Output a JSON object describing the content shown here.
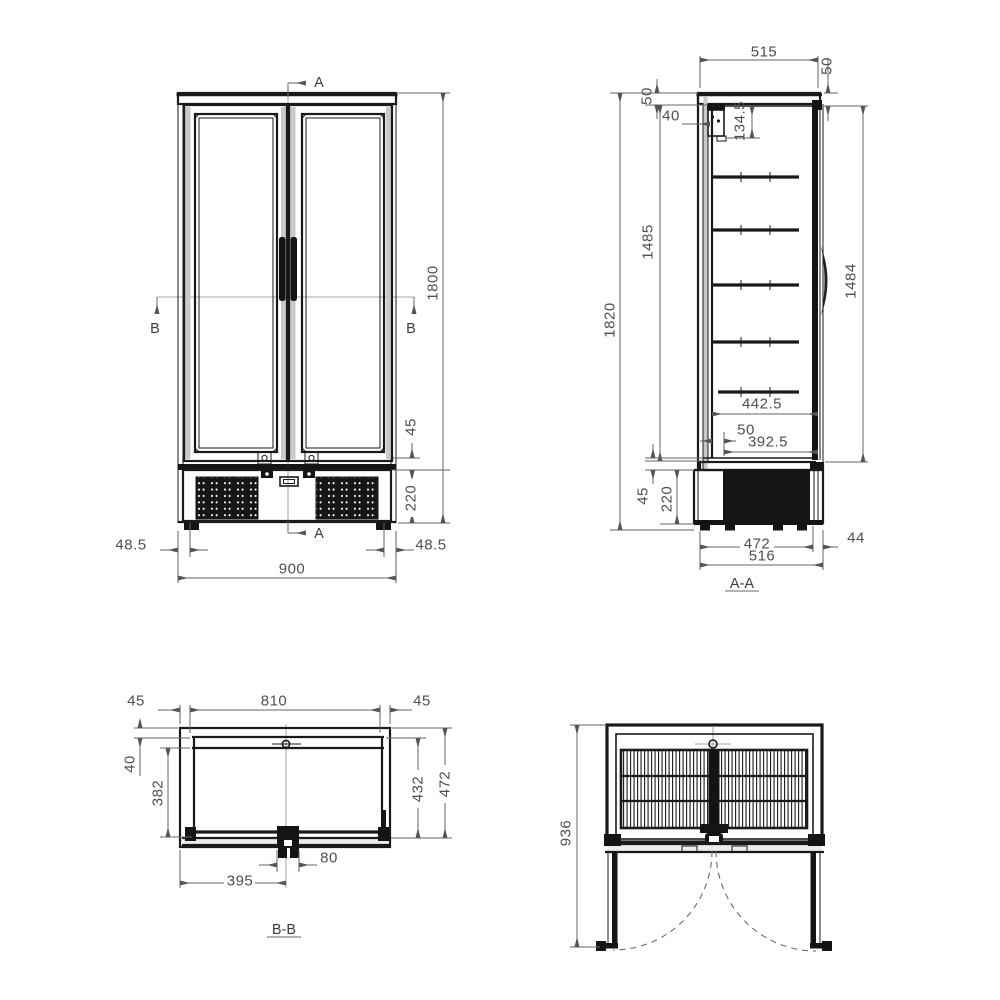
{
  "palette": {
    "line": "#1a1a1a",
    "dim_line": "#666666",
    "dim_text": "#4f4f4f",
    "shade": "#c9c9c9",
    "background": "#ffffff"
  },
  "front": {
    "section_a": "A",
    "section_b": "B",
    "height_total": "1800",
    "door_gap": "45",
    "base_height": "220",
    "offset_left": "48.5",
    "offset_right": "48.5",
    "width_total": "900"
  },
  "aa": {
    "title": "A-A",
    "width_top": "515",
    "top_right": "50",
    "top_left": "50",
    "evap_width": "40",
    "evap_height": "134.5",
    "height_inner": "1485",
    "height_total": "1820",
    "height_door": "1484",
    "shelf_depth": "442.5",
    "wall_gap": "50",
    "inner_depth": "392.5",
    "gap": "45",
    "base_height": "220",
    "base_depth": "472",
    "door_thickness": "44",
    "depth_total": "516"
  },
  "bb": {
    "title": "B-B",
    "wall_left": "45",
    "width_inner": "810",
    "wall_right": "45",
    "back_wall": "40",
    "liner_depth": "382",
    "door_depth": "432",
    "depth_total": "472",
    "mullion_width": "80",
    "half_width": "395"
  },
  "top": {
    "open_depth": "936"
  }
}
